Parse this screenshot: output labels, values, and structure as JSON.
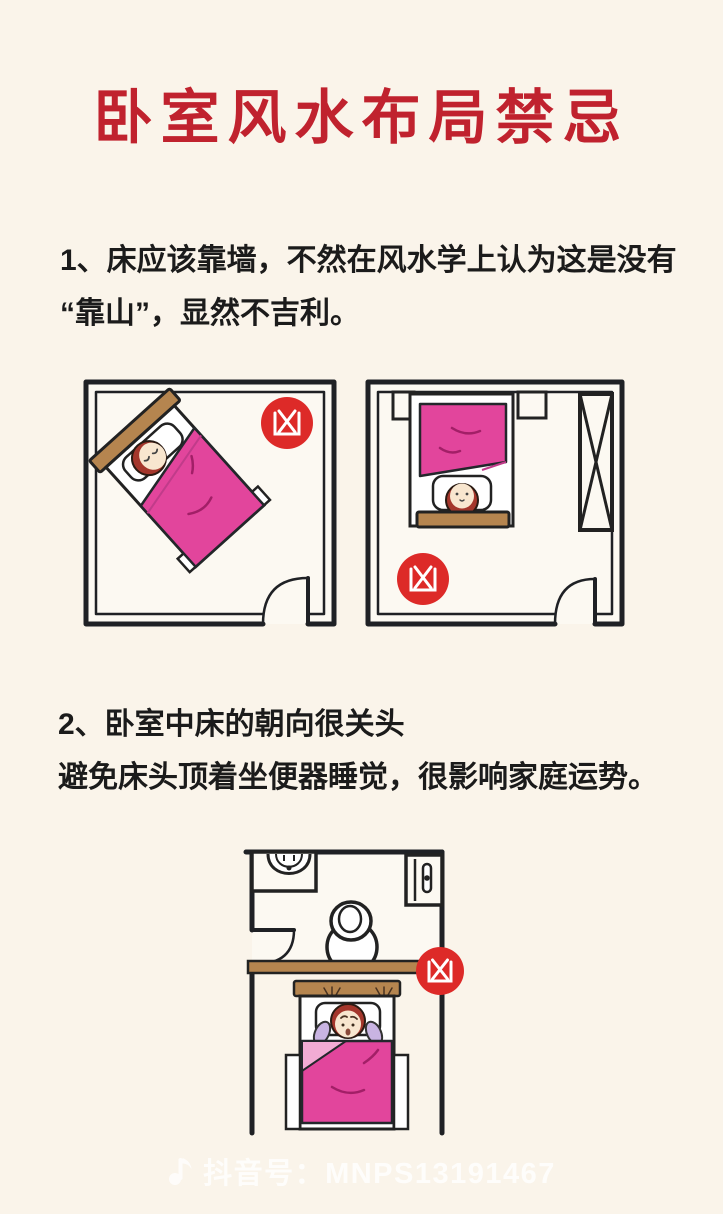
{
  "poster": {
    "title": "卧室风水布局禁忌",
    "rules": [
      {
        "number": "1",
        "lines": [
          "1、床应该靠墙，不然在风水学上认为这是没有",
          "“靠山”，显然不吉利。"
        ]
      },
      {
        "number": "2",
        "lines": [
          "2、卧室中床的朝向很关头",
          "避免床头顶着坐便器睡觉，很影响家庭运势。"
        ]
      }
    ]
  },
  "badge": {
    "char": "凶"
  },
  "diagrams": [
    {
      "name": "room-bed-diagonal-not-against-wall",
      "badge_label": "凶"
    },
    {
      "name": "room-bed-head-away-from-wall-with-wardrobe",
      "badge_label": "凶"
    },
    {
      "name": "bathroom-toilet-behind-bed-headboard",
      "badge_label": "凶"
    }
  ],
  "footer": {
    "icon": "douyin-music-note-icon",
    "text": "抖音号：MNPS13191467"
  },
  "colors": {
    "background": "#faf4ea",
    "title_red": "#c0222e",
    "badge_red": "#dd2a28",
    "blanket_pink": "#e2459c",
    "blanket_fold_pink": "#f2abd4",
    "headboard_brown": "#b5854f",
    "hair_auburn": "#a4362b",
    "text_black": "#1b1b1b"
  }
}
